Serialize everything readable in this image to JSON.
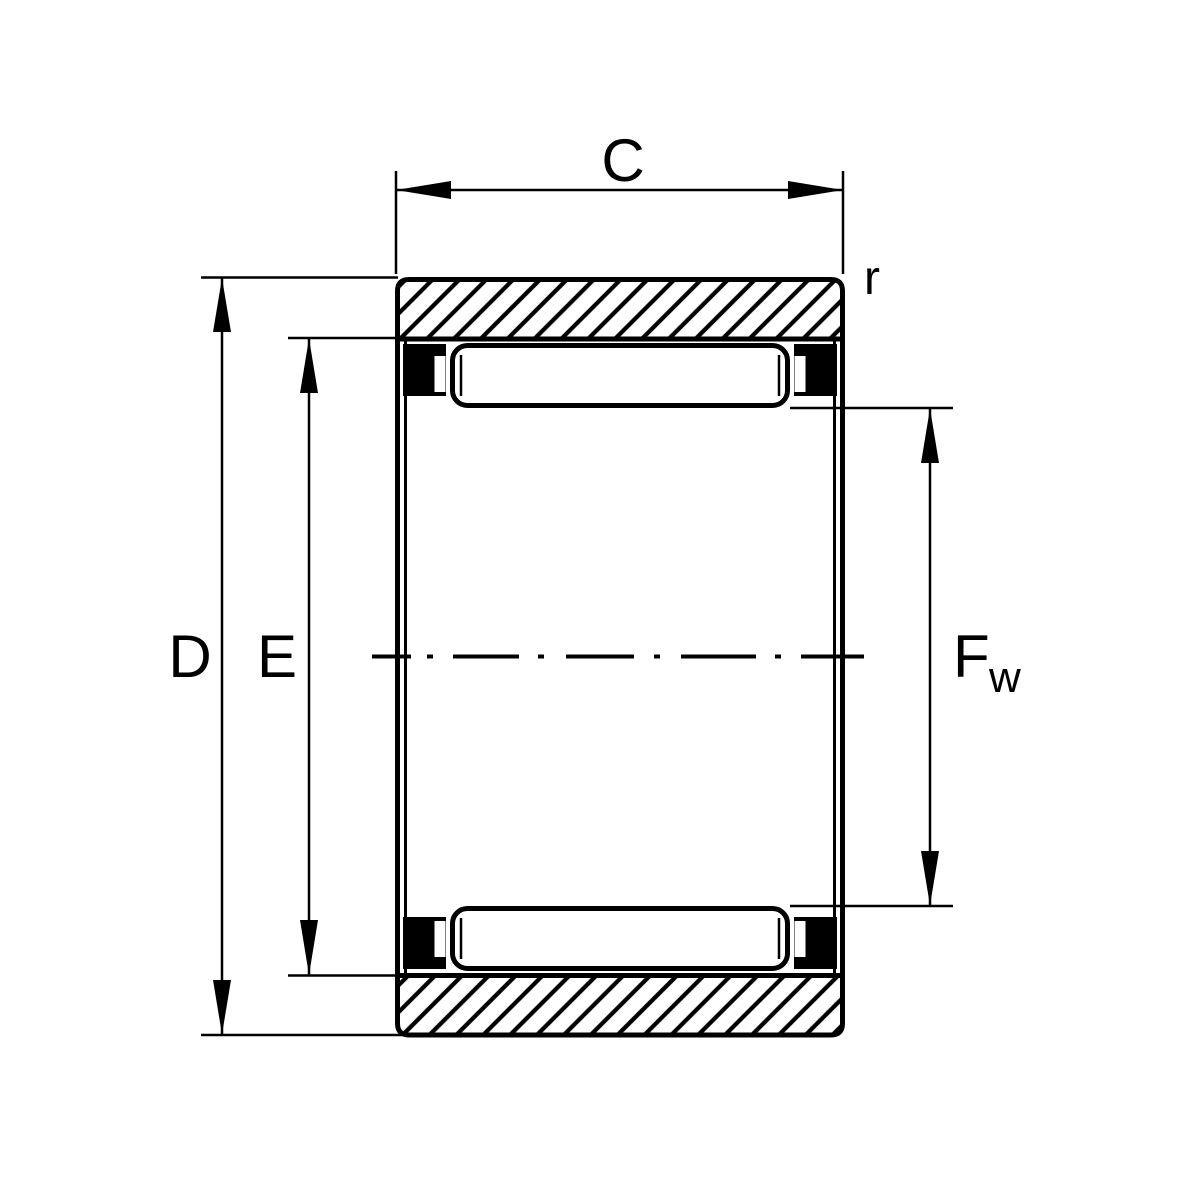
{
  "drawing": {
    "background_color": "#ffffff",
    "line_color": "#000000",
    "labels": {
      "width_c": "C",
      "corner_radius_r": "r",
      "outer_diameter_d": "D",
      "raceway_diameter_e": "E",
      "bore_fw_main": "F",
      "bore_fw_subscript": "w"
    }
  }
}
